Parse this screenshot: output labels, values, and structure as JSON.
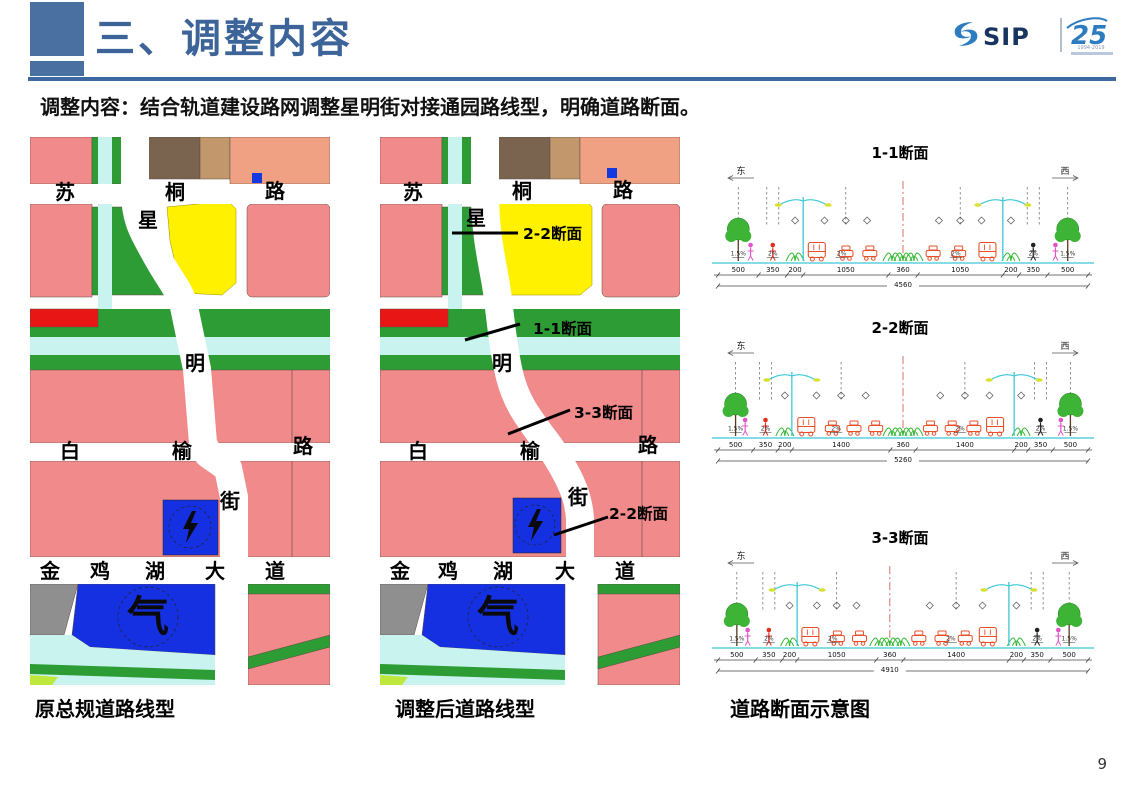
{
  "slide": {
    "title": "三、调整内容",
    "subtitle": "调整内容：结合轨道建设路网调整星明街对接通园路线型，明确道路断面。",
    "page_number": "9"
  },
  "logo": {
    "brand": "SIP",
    "anniversary": "25",
    "years": "1994-2019"
  },
  "captions": {
    "left": "原总规道路线型",
    "middle": "调整后道路线型",
    "right": "道路断面示意图"
  },
  "map_labels": {
    "sutong": [
      "苏",
      "桐",
      "路"
    ],
    "xingming": [
      "星",
      "明",
      "街"
    ],
    "baiyu": [
      "白",
      "榆",
      "路"
    ],
    "jinjihu": [
      "金",
      "鸡",
      "湖",
      "大",
      "道"
    ],
    "gas_symbol": "气"
  },
  "middle_annotations": [
    "2-2断面",
    "1-1断面",
    "3-3断面",
    "2-2断面"
  ],
  "sections": [
    {
      "title": "1-1断面",
      "east": "东",
      "west": "西",
      "dims": [
        "500",
        "350",
        "200",
        "1050",
        "360",
        "1050",
        "200",
        "350",
        "500"
      ],
      "total": "4560",
      "slopes": [
        "1.5%",
        "2%",
        "2%",
        "2%",
        "2%",
        "1.5%"
      ]
    },
    {
      "title": "2-2断面",
      "east": "东",
      "west": "西",
      "dims": [
        "500",
        "350",
        "200",
        "1400",
        "360",
        "1400",
        "200",
        "350",
        "500"
      ],
      "total": "5260",
      "slopes": [
        "1.5%",
        "2%",
        "2%",
        "2%",
        "2%",
        "1.5%"
      ]
    },
    {
      "title": "3-3断面",
      "east": "东",
      "west": "西",
      "dims": [
        "500",
        "350",
        "200",
        "1050",
        "360",
        "1400",
        "200",
        "350",
        "500"
      ],
      "total": "4910",
      "slopes": [
        "1.5%",
        "2%",
        "2%",
        "2%",
        "2%",
        "1.5%"
      ]
    }
  ]
}
